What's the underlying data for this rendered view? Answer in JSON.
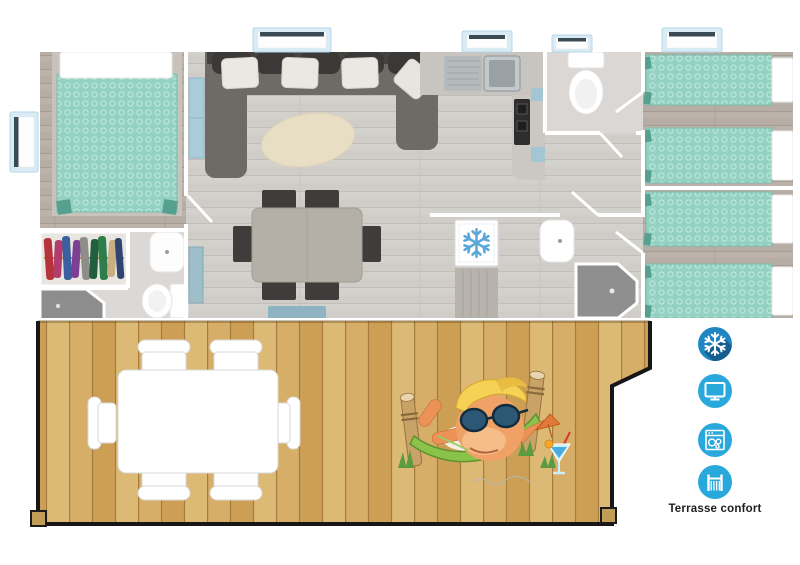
{
  "scene": {
    "description": "Top-down 3D floor plan of a mobile home with a living-kitchen area, master bedroom, two twin bedrooms, two shower rooms, WC and a large wooden terrace",
    "background_color": "#ffffff"
  },
  "amenities": {
    "caption": "Terrasse confort",
    "items": [
      {
        "name": "air-conditioning",
        "icon": "snowflake-icon",
        "circle_color": "#1f86c2",
        "shadow_color": "#155f91",
        "glyph_color": "#ffffff"
      },
      {
        "name": "television",
        "icon": "tv-icon",
        "circle_color": "#29a8dc",
        "glyph_color": "#ffffff"
      },
      {
        "name": "dishwasher",
        "icon": "dishwasher-icon",
        "circle_color": "#29a8dc",
        "glyph_color": "#ffffff"
      },
      {
        "name": "terrace",
        "icon": "terrace-railing-icon",
        "circle_color": "#29a8dc",
        "glyph_color": "#ffffff"
      }
    ]
  },
  "floor_plan": {
    "rooms": [
      {
        "name": "master-bedroom",
        "furniture": [
          "double-bed",
          "wardrobe"
        ]
      },
      {
        "name": "shower-room-1",
        "furniture": [
          "shower",
          "washbasin",
          "toilet"
        ]
      },
      {
        "name": "living-room",
        "furniture": [
          "corner-sofa",
          "rug",
          "dining-table",
          "six-chairs",
          "bench"
        ]
      },
      {
        "name": "kitchen",
        "furniture": [
          "sink",
          "cooktop",
          "fridge-freezer"
        ]
      },
      {
        "name": "wc",
        "furniture": [
          "toilet"
        ]
      },
      {
        "name": "shower-room-2",
        "furniture": [
          "shower",
          "washbasin"
        ]
      },
      {
        "name": "twin-bedroom-1",
        "furniture": [
          "single-bed",
          "single-bed"
        ]
      },
      {
        "name": "twin-bedroom-2",
        "furniture": [
          "single-bed",
          "single-bed"
        ]
      }
    ],
    "window_count": 5,
    "colors": {
      "bedding_teal": "#93d1c3",
      "floor_grey": "#d0cdc9",
      "floor_brown": "#b6ada4",
      "sofa_grey": "#6e6b67",
      "wall_white": "#ffffff",
      "fridge_snowflake_blue": "#5aa7d8",
      "window_frame_blue": "#d9ecf6"
    }
  },
  "terrace": {
    "deck_color": "#d6ad66",
    "furniture": [
      "outdoor-table",
      "six-outdoor-chairs"
    ],
    "mascot": "blond elf wearing sunglasses relaxing in a green hammock with a cocktail"
  }
}
